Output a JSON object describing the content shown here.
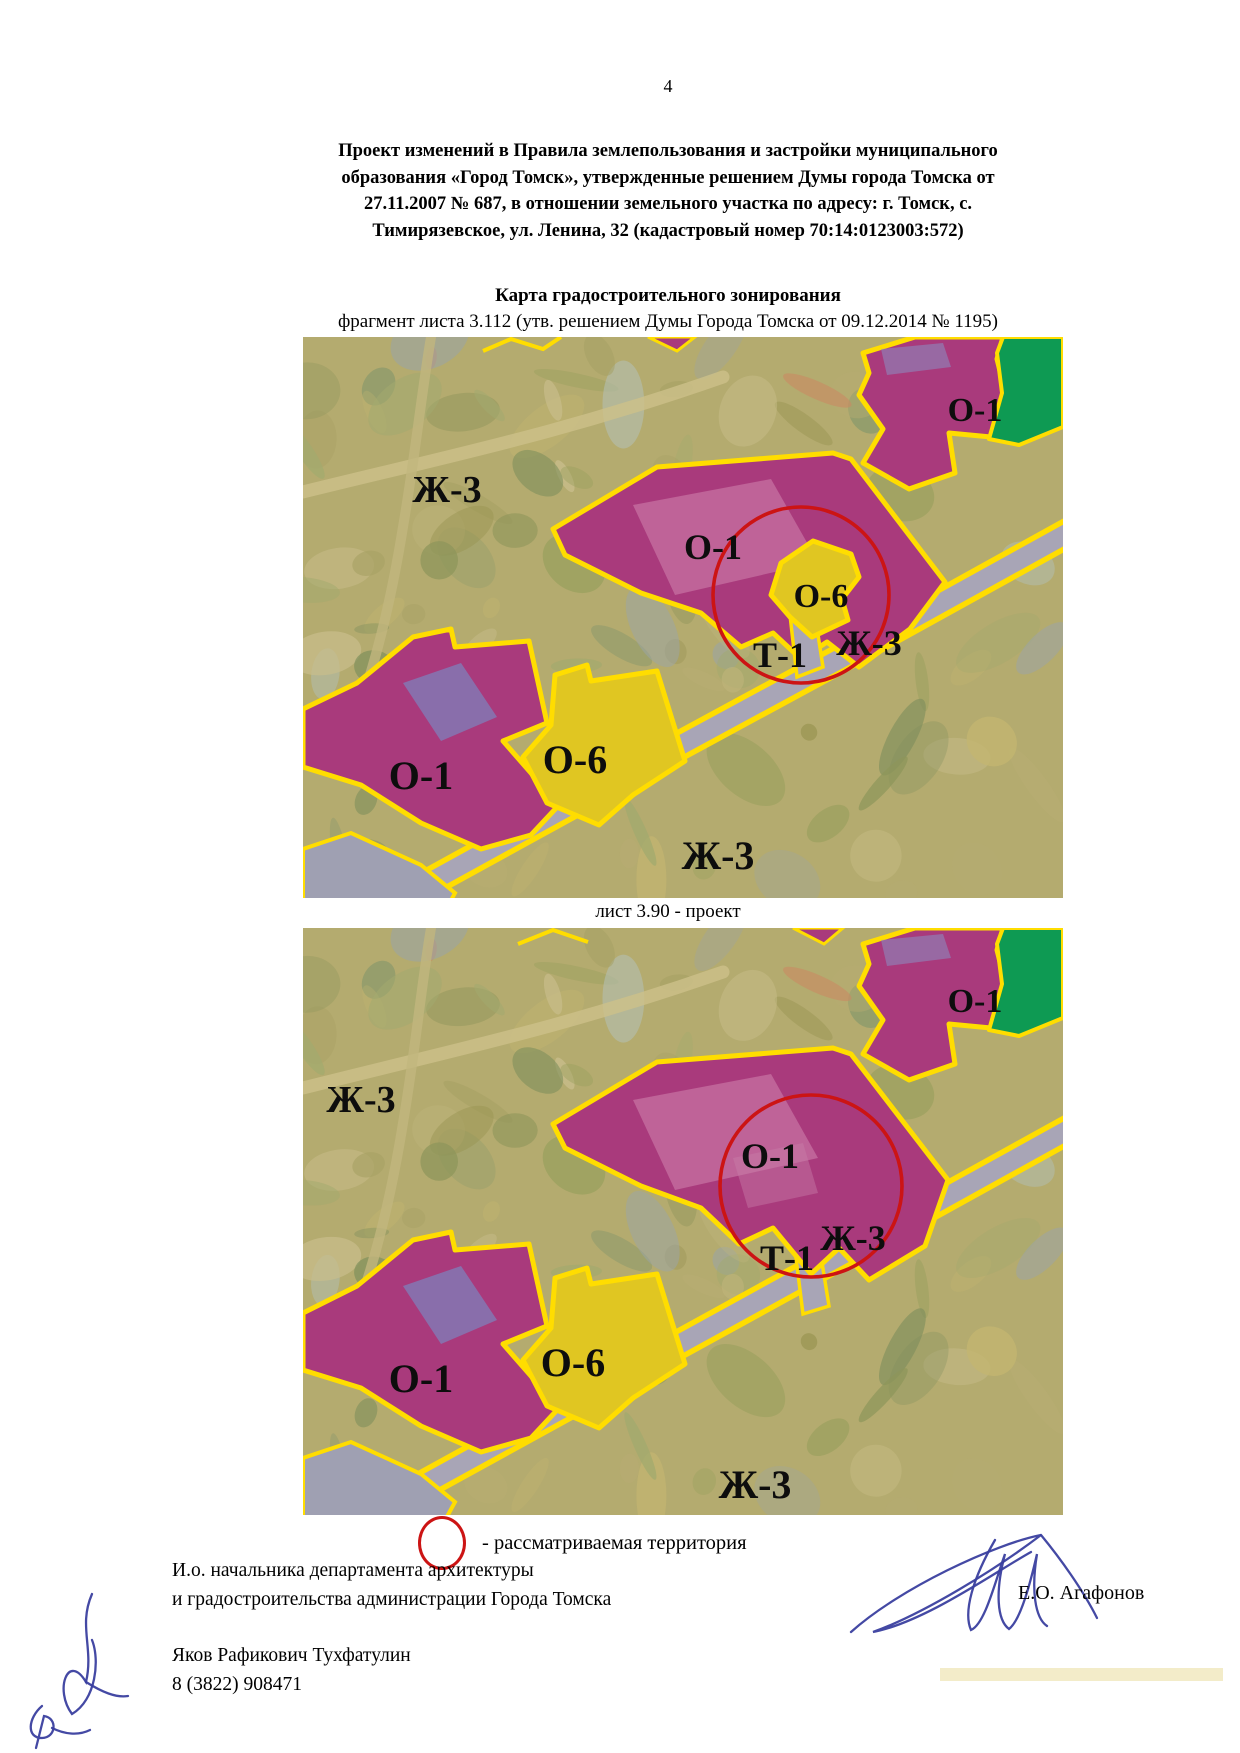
{
  "page": {
    "number": "4"
  },
  "header": {
    "title_lines": [
      "Проект изменений в Правила землепользования и застройки муниципального",
      "образования «Город Томск», утвержденные решением Думы города Томска от",
      "27.11.2007 № 687, в отношении земельного участка по адресу: г. Томск, с.",
      "Тимирязевское, ул. Ленина, 32 (кадастровый номер 70:14:0123003:572)"
    ],
    "map_section_title": "Карта градостроительного зонирования"
  },
  "maps": {
    "existing": {
      "caption": "фрагмент листа 3.112 (утв. решением Думы Города Томска от 09.12.2014 № 1195)",
      "labels": [
        {
          "text": "Ж-3",
          "x": 144,
          "y": 165,
          "size": 38
        },
        {
          "text": "О-1",
          "x": 672,
          "y": 84,
          "size": 34
        },
        {
          "text": "О-1",
          "x": 410,
          "y": 222,
          "size": 36
        },
        {
          "text": "О-6",
          "x": 518,
          "y": 270,
          "size": 34
        },
        {
          "text": "Т-1",
          "x": 477,
          "y": 330,
          "size": 36
        },
        {
          "text": "Ж-3",
          "x": 566,
          "y": 318,
          "size": 36
        },
        {
          "text": "О-1",
          "x": 118,
          "y": 452,
          "size": 40
        },
        {
          "text": "О-6",
          "x": 272,
          "y": 436,
          "size": 40
        },
        {
          "text": "Ж-3",
          "x": 415,
          "y": 532,
          "size": 40
        }
      ]
    },
    "project": {
      "caption": "лист 3.90 - проект",
      "labels": [
        {
          "text": "Ж-3",
          "x": 58,
          "y": 184,
          "size": 38
        },
        {
          "text": "О-1",
          "x": 672,
          "y": 84,
          "size": 34
        },
        {
          "text": "О-1",
          "x": 467,
          "y": 240,
          "size": 36
        },
        {
          "text": "Т-1",
          "x": 484,
          "y": 342,
          "size": 36
        },
        {
          "text": "Ж-3",
          "x": 550,
          "y": 322,
          "size": 36
        },
        {
          "text": "О-1",
          "x": 118,
          "y": 464,
          "size": 40
        },
        {
          "text": "О-6",
          "x": 270,
          "y": 448,
          "size": 40
        },
        {
          "text": "Ж-3",
          "x": 452,
          "y": 570,
          "size": 40
        }
      ]
    }
  },
  "legend": {
    "symbol": "red-circle",
    "text": "- рассматриваемая территория"
  },
  "signature": {
    "position_line1": "И.о. начальника департамента архитектуры",
    "position_line2": "и градостроительства администрации Города Томска",
    "signer_name": "Е.О. Агафонов",
    "contact_name": "Яков Рафикович Тухфатулин",
    "contact_phone": "8 (3822) 908471"
  },
  "colors": {
    "zone_o1_fill": "#a93a7c",
    "zone_o6_fill": "#e0c622",
    "zone_green_fill": "#0e9a53",
    "zone_border": "#ffdd00",
    "road_fill": "#a8a5b6",
    "terrain_base": "#b4ab6f",
    "highlight_circle": "#cc1414",
    "signature_ink": "#3a3f9f"
  }
}
